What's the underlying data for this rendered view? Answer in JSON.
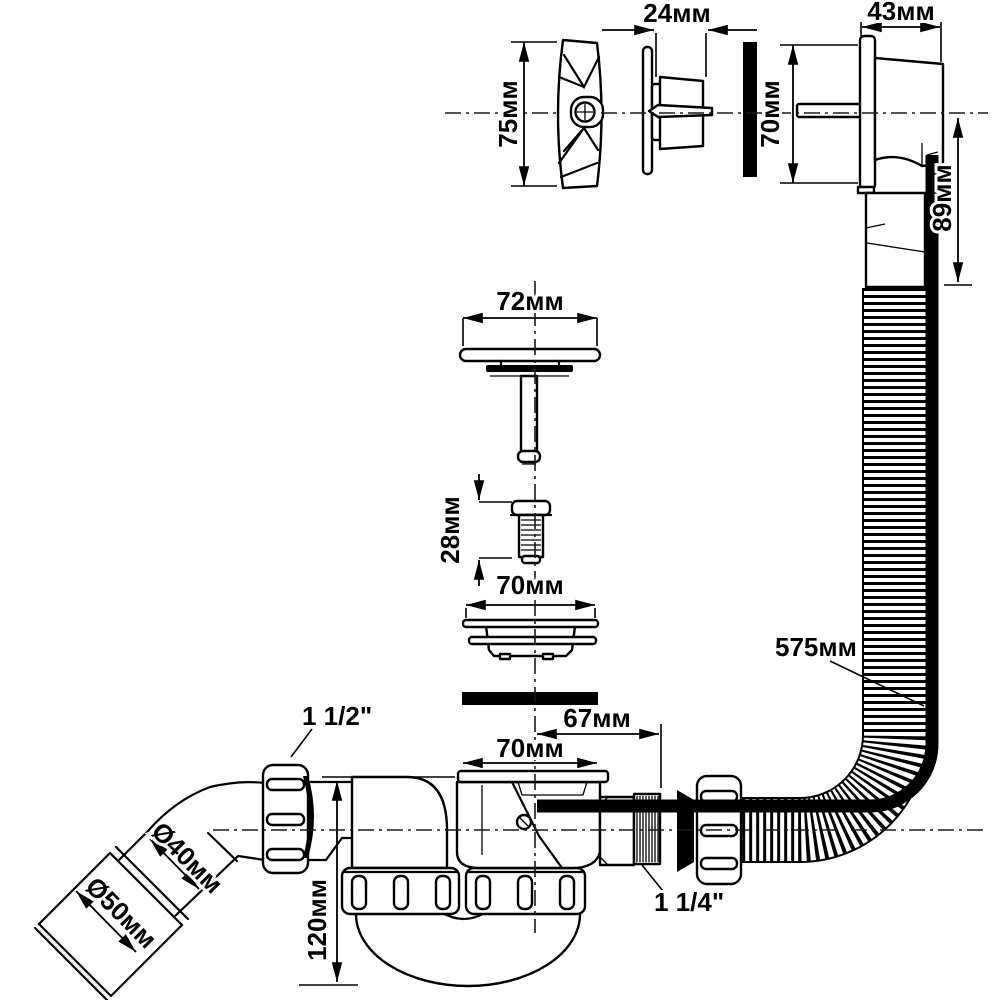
{
  "style": {
    "background": "#ffffff",
    "ink": "#000000"
  },
  "drawing": {
    "kind": "technical-drawing",
    "units_note": ""
  },
  "labels": {
    "overflow_cover_height": "75мм",
    "overflow_trim_depth": "24мм",
    "overflow_body_depth": "43мм",
    "overflow_body_height": "70мм",
    "overflow_outlet_drop": "89мм",
    "plug_cover_width": "72мм",
    "screw_length": "28мм",
    "strainer_width": "70мм",
    "hose_length": "575мм",
    "outlet_nut_thread": "1 1/2\"",
    "outlet_offset": "67мм",
    "body_flange_width": "70мм",
    "pipe_diameter": "Ø40мм",
    "socket_diameter": "Ø50мм",
    "trap_depth": "120мм",
    "hose_nut_thread": "1 1/4\""
  }
}
